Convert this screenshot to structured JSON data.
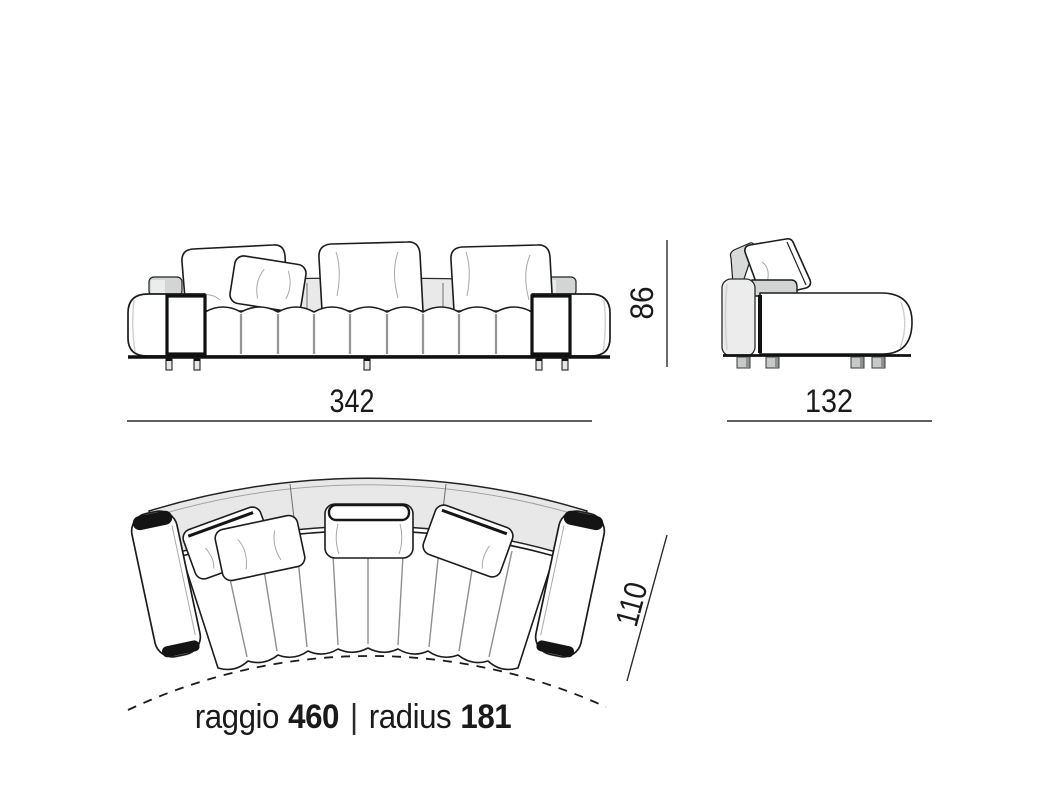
{
  "drawing": {
    "type": "furniture-dimension-diagram",
    "subject": "curved-sofa",
    "views": {
      "front": "front-elevation",
      "side": "side-elevation",
      "top": "top-plan"
    },
    "dimensions": {
      "front_width": "342",
      "side_depth": "132",
      "height": "86",
      "top_depth": "110"
    },
    "caption": {
      "raggio_label": "raggio",
      "raggio_value": "460",
      "separator": "|",
      "radius_label": "radius",
      "radius_value": "181"
    },
    "colors": {
      "background": "#ffffff",
      "outline": "#1a1a1a",
      "back_band": "#e8e8e8",
      "panel_gray": "#ececec",
      "block_gray": "#d2d3d3",
      "shading_gray": "#bdbdbd",
      "dark_cap": "#141414",
      "leg_gray": "#c7c9c9",
      "text": "#1a1a1a"
    }
  }
}
